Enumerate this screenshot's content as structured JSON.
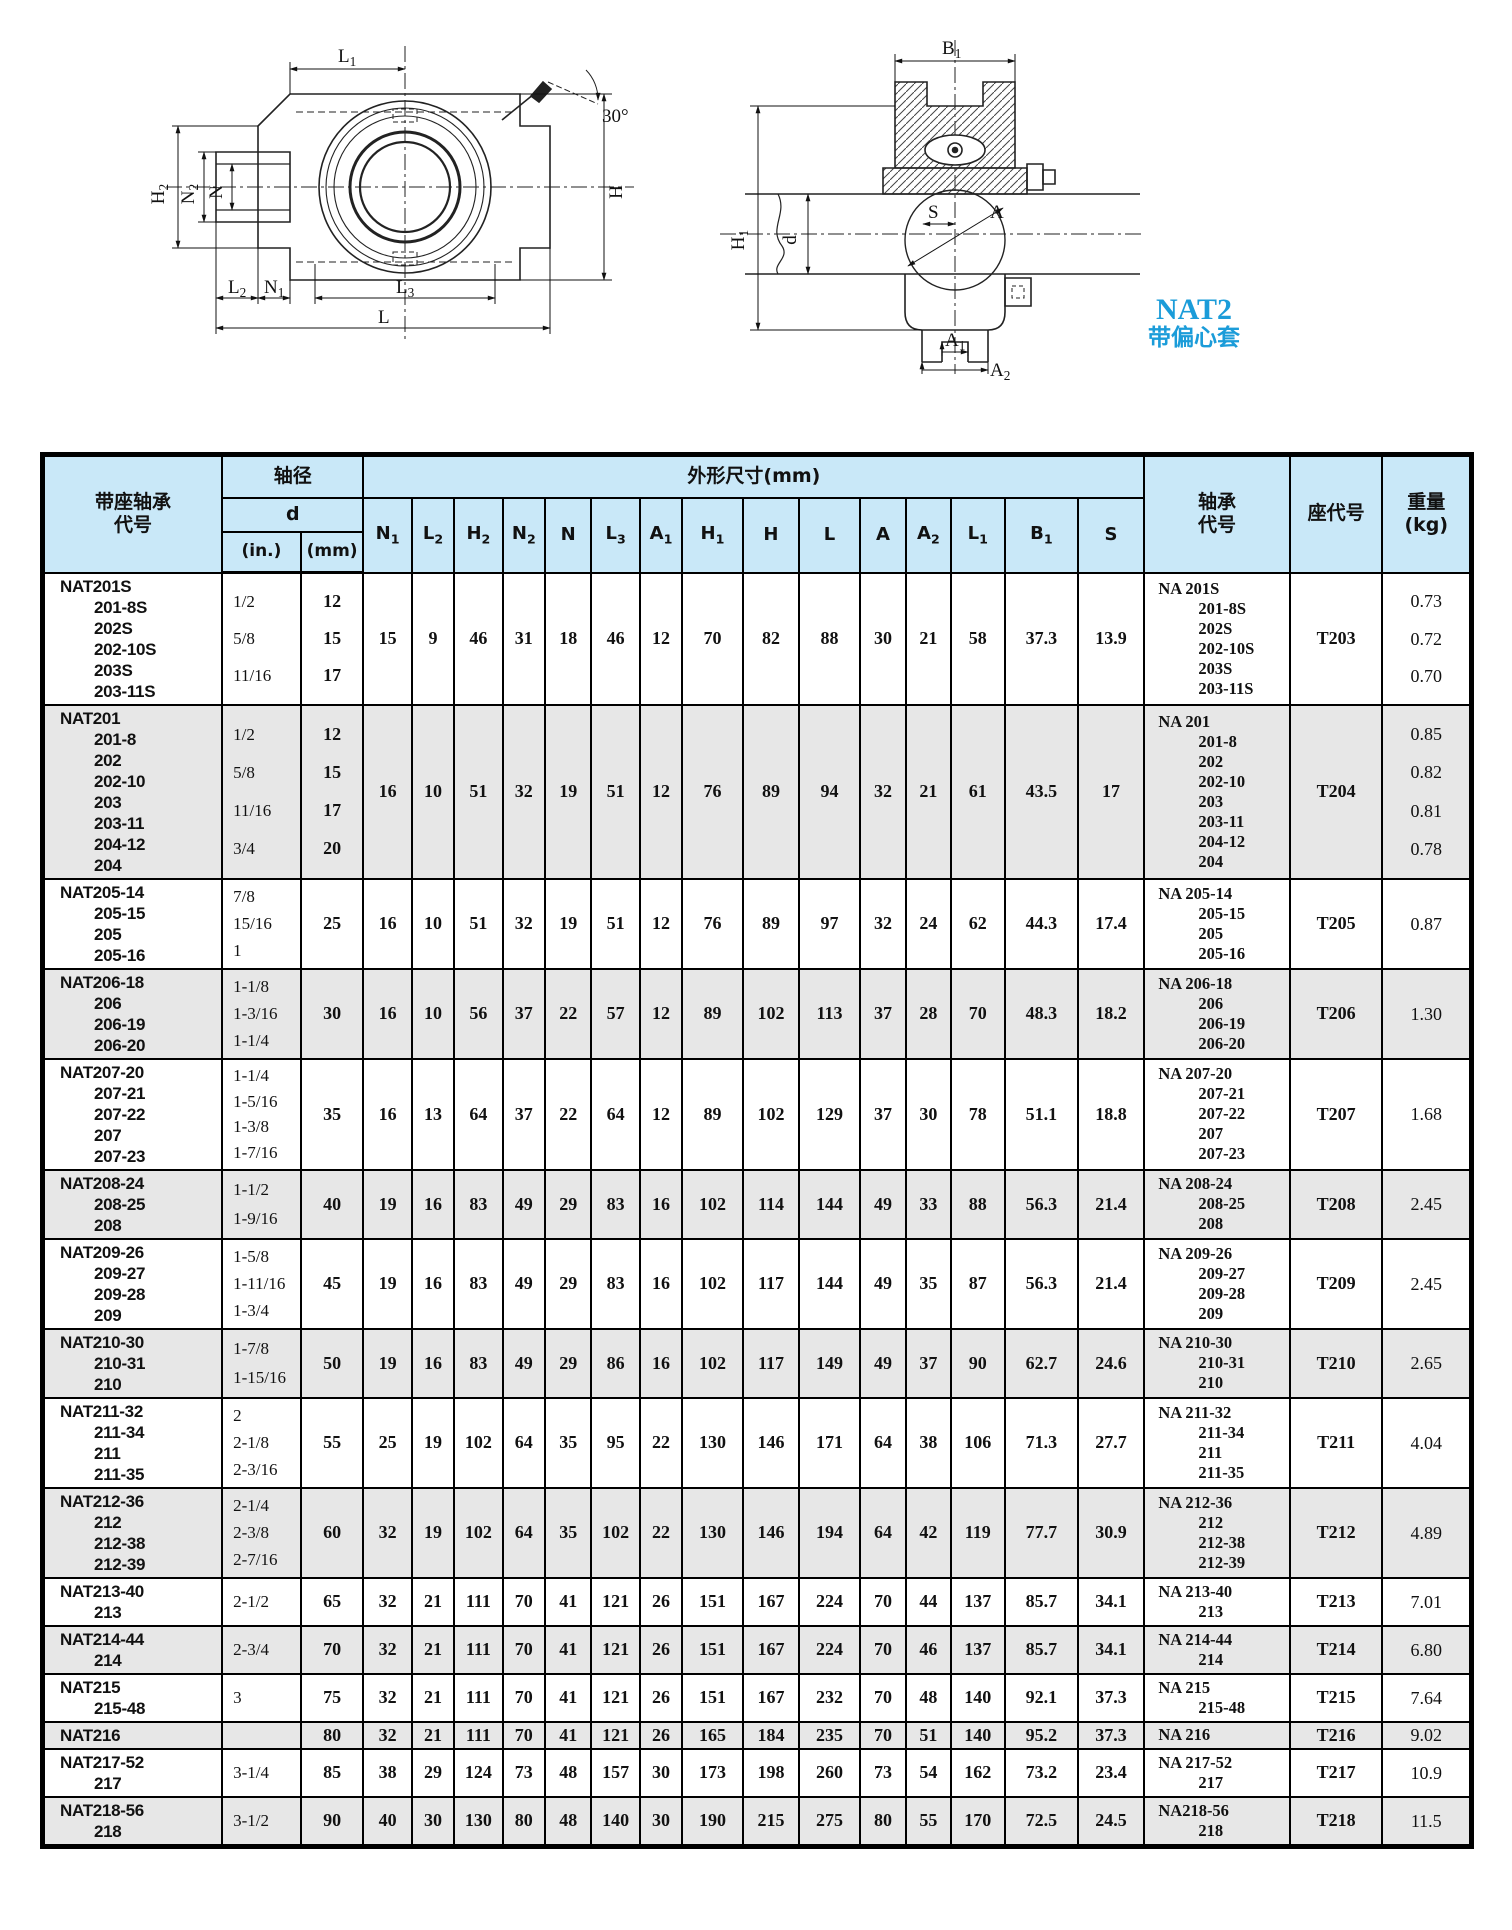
{
  "diagrams": {
    "front_view_labels": [
      "L1",
      "H2",
      "N2",
      "N",
      "30°",
      "H",
      "L2",
      "N1",
      "L3",
      "L"
    ],
    "side_view_labels": [
      "B1",
      "H1",
      "d",
      "S",
      "A",
      "A1",
      "A2"
    ],
    "callout": {
      "series": "NAT2",
      "desc": "带偏心套"
    }
  },
  "table": {
    "headers": {
      "unit_code": "带座轴承\n代号",
      "shaft_dia": "轴径",
      "d": "d",
      "in": "(in.)",
      "mm": "(mm)",
      "dims_group": "外形尺寸(mm)",
      "dim_cols": [
        "N1",
        "L2",
        "H2",
        "N2",
        "N",
        "L3",
        "A1",
        "H1",
        "H",
        "L",
        "A",
        "A2",
        "L1",
        "B1",
        "S"
      ],
      "bearing_code": "轴承\n代号",
      "housing_code": "座代号",
      "weight": "重量\n(kg)"
    },
    "rows": [
      {
        "codes": [
          "NAT201S",
          "201-8S",
          "202S",
          "202-10S",
          "203S",
          "203-11S"
        ],
        "in": [
          "1/2",
          "5/8",
          "11/16"
        ],
        "mm": [
          "12",
          "15",
          "17"
        ],
        "dims": [
          "15",
          "9",
          "46",
          "31",
          "18",
          "46",
          "12",
          "70",
          "82",
          "88",
          "30",
          "21",
          "58",
          "37.3",
          "13.9"
        ],
        "bearing": [
          "NA 201S",
          "201-8S",
          "202S",
          "202-10S",
          "203S",
          "203-11S"
        ],
        "housing": "T203",
        "weight": [
          "0.73",
          "0.72",
          "0.70"
        ]
      },
      {
        "codes": [
          "NAT201",
          "201-8",
          "202",
          "202-10",
          "203",
          "203-11",
          "204-12",
          "204"
        ],
        "in": [
          "1/2",
          "5/8",
          "11/16",
          "3/4"
        ],
        "mm": [
          "12",
          "15",
          "17",
          "20"
        ],
        "dims": [
          "16",
          "10",
          "51",
          "32",
          "19",
          "51",
          "12",
          "76",
          "89",
          "94",
          "32",
          "21",
          "61",
          "43.5",
          "17"
        ],
        "bearing": [
          "NA 201",
          "201-8",
          "202",
          "202-10",
          "203",
          "203-11",
          "204-12",
          "204"
        ],
        "housing": "T204",
        "weight": [
          "0.85",
          "0.82",
          "0.81",
          "0.78"
        ]
      },
      {
        "codes": [
          "NAT205-14",
          "205-15",
          "205",
          "205-16"
        ],
        "in": [
          "7/8",
          "15/16",
          "1"
        ],
        "mm": [
          "25"
        ],
        "dims": [
          "16",
          "10",
          "51",
          "32",
          "19",
          "51",
          "12",
          "76",
          "89",
          "97",
          "32",
          "24",
          "62",
          "44.3",
          "17.4"
        ],
        "bearing": [
          "NA 205-14",
          "205-15",
          "205",
          "205-16"
        ],
        "housing": "T205",
        "weight": [
          "0.87"
        ]
      },
      {
        "codes": [
          "NAT206-18",
          "206",
          "206-19",
          "206-20"
        ],
        "in": [
          "1-1/8",
          "1-3/16",
          "1-1/4"
        ],
        "mm": [
          "30"
        ],
        "dims": [
          "16",
          "10",
          "56",
          "37",
          "22",
          "57",
          "12",
          "89",
          "102",
          "113",
          "37",
          "28",
          "70",
          "48.3",
          "18.2"
        ],
        "bearing": [
          "NA 206-18",
          "206",
          "206-19",
          "206-20"
        ],
        "housing": "T206",
        "weight": [
          "1.30"
        ]
      },
      {
        "codes": [
          "NAT207-20",
          "207-21",
          "207-22",
          "207",
          "207-23"
        ],
        "in": [
          "1-1/4",
          "1-5/16",
          "1-3/8",
          "1-7/16"
        ],
        "mm": [
          "35"
        ],
        "dims": [
          "16",
          "13",
          "64",
          "37",
          "22",
          "64",
          "12",
          "89",
          "102",
          "129",
          "37",
          "30",
          "78",
          "51.1",
          "18.8"
        ],
        "bearing": [
          "NA 207-20",
          "207-21",
          "207-22",
          "207",
          "207-23"
        ],
        "housing": "T207",
        "weight": [
          "1.68"
        ]
      },
      {
        "codes": [
          "NAT208-24",
          "208-25",
          "208"
        ],
        "in": [
          "1-1/2",
          "1-9/16"
        ],
        "mm": [
          "40"
        ],
        "dims": [
          "19",
          "16",
          "83",
          "49",
          "29",
          "83",
          "16",
          "102",
          "114",
          "144",
          "49",
          "33",
          "88",
          "56.3",
          "21.4"
        ],
        "bearing": [
          "NA 208-24",
          "208-25",
          "208"
        ],
        "housing": "T208",
        "weight": [
          "2.45"
        ]
      },
      {
        "codes": [
          "NAT209-26",
          "209-27",
          "209-28",
          "209"
        ],
        "in": [
          "1-5/8",
          "1-11/16",
          "1-3/4"
        ],
        "mm": [
          "45"
        ],
        "dims": [
          "19",
          "16",
          "83",
          "49",
          "29",
          "83",
          "16",
          "102",
          "117",
          "144",
          "49",
          "35",
          "87",
          "56.3",
          "21.4"
        ],
        "bearing": [
          "NA 209-26",
          "209-27",
          "209-28",
          "209"
        ],
        "housing": "T209",
        "weight": [
          "2.45"
        ]
      },
      {
        "codes": [
          "NAT210-30",
          "210-31",
          "210"
        ],
        "in": [
          "1-7/8",
          "1-15/16"
        ],
        "mm": [
          "50"
        ],
        "dims": [
          "19",
          "16",
          "83",
          "49",
          "29",
          "86",
          "16",
          "102",
          "117",
          "149",
          "49",
          "37",
          "90",
          "62.7",
          "24.6"
        ],
        "bearing": [
          "NA 210-30",
          "210-31",
          "210"
        ],
        "housing": "T210",
        "weight": [
          "2.65"
        ]
      },
      {
        "codes": [
          "NAT211-32",
          "211-34",
          "211",
          "211-35"
        ],
        "in": [
          "2",
          "2-1/8",
          "2-3/16"
        ],
        "mm": [
          "55"
        ],
        "dims": [
          "25",
          "19",
          "102",
          "64",
          "35",
          "95",
          "22",
          "130",
          "146",
          "171",
          "64",
          "38",
          "106",
          "71.3",
          "27.7"
        ],
        "bearing": [
          "NA 211-32",
          "211-34",
          "211",
          "211-35"
        ],
        "housing": "T211",
        "weight": [
          "4.04"
        ]
      },
      {
        "codes": [
          "NAT212-36",
          "212",
          "212-38",
          "212-39"
        ],
        "in": [
          "2-1/4",
          "2-3/8",
          "2-7/16"
        ],
        "mm": [
          "60"
        ],
        "dims": [
          "32",
          "19",
          "102",
          "64",
          "35",
          "102",
          "22",
          "130",
          "146",
          "194",
          "64",
          "42",
          "119",
          "77.7",
          "30.9"
        ],
        "bearing": [
          "NA 212-36",
          "212",
          "212-38",
          "212-39"
        ],
        "housing": "T212",
        "weight": [
          "4.89"
        ]
      },
      {
        "codes": [
          "NAT213-40",
          "213"
        ],
        "in": [
          "2-1/2"
        ],
        "mm": [
          "65"
        ],
        "dims": [
          "32",
          "21",
          "111",
          "70",
          "41",
          "121",
          "26",
          "151",
          "167",
          "224",
          "70",
          "44",
          "137",
          "85.7",
          "34.1"
        ],
        "bearing": [
          "NA 213-40",
          "213"
        ],
        "housing": "T213",
        "weight": [
          "7.01"
        ]
      },
      {
        "codes": [
          "NAT214-44",
          "214"
        ],
        "in": [
          "2-3/4"
        ],
        "mm": [
          "70"
        ],
        "dims": [
          "32",
          "21",
          "111",
          "70",
          "41",
          "121",
          "26",
          "151",
          "167",
          "224",
          "70",
          "46",
          "137",
          "85.7",
          "34.1"
        ],
        "bearing": [
          "NA 214-44",
          "214"
        ],
        "housing": "T214",
        "weight": [
          "6.80"
        ]
      },
      {
        "codes": [
          "NAT215",
          "215-48"
        ],
        "in": [
          "3"
        ],
        "mm": [
          "75"
        ],
        "dims": [
          "32",
          "21",
          "111",
          "70",
          "41",
          "121",
          "26",
          "151",
          "167",
          "232",
          "70",
          "48",
          "140",
          "92.1",
          "37.3"
        ],
        "bearing": [
          "NA 215",
          "215-48"
        ],
        "housing": "T215",
        "weight": [
          "7.64"
        ]
      },
      {
        "codes": [
          "NAT216"
        ],
        "in": [],
        "mm": [
          "80"
        ],
        "dims": [
          "32",
          "21",
          "111",
          "70",
          "41",
          "121",
          "26",
          "165",
          "184",
          "235",
          "70",
          "51",
          "140",
          "95.2",
          "37.3"
        ],
        "bearing": [
          "NA 216"
        ],
        "housing": "T216",
        "weight": [
          "9.02"
        ]
      },
      {
        "codes": [
          "NAT217-52",
          "217"
        ],
        "in": [
          "3-1/4"
        ],
        "mm": [
          "85"
        ],
        "dims": [
          "38",
          "29",
          "124",
          "73",
          "48",
          "157",
          "30",
          "173",
          "198",
          "260",
          "73",
          "54",
          "162",
          "73.2",
          "23.4"
        ],
        "bearing": [
          "NA 217-52",
          "217"
        ],
        "housing": "T217",
        "weight": [
          "10.9"
        ]
      },
      {
        "codes": [
          "NAT218-56",
          "218"
        ],
        "in": [
          "3-1/2"
        ],
        "mm": [
          "90"
        ],
        "dims": [
          "40",
          "30",
          "130",
          "80",
          "48",
          "140",
          "30",
          "190",
          "215",
          "275",
          "80",
          "55",
          "170",
          "72.5",
          "24.5"
        ],
        "bearing": [
          "NA218-56",
          "218"
        ],
        "housing": "T218",
        "weight": [
          "11.5"
        ]
      }
    ]
  }
}
